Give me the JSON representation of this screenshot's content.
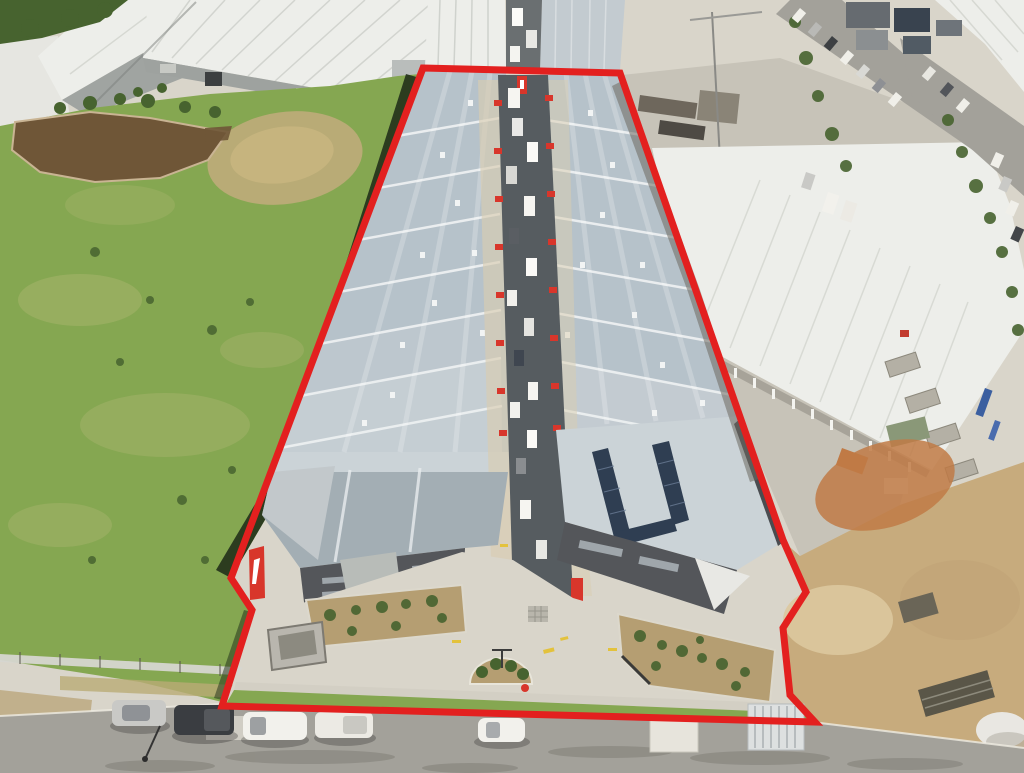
{
  "image": {
    "kind": "aerial-drone-photograph",
    "subject": "industrial warehouse estate outlined with red property boundary",
    "width": 1024,
    "height": 773
  },
  "boundary": {
    "points": "423,68 620,73 783,540 806,592 783,628 790,695 815,722 222,706 252,610 231,578",
    "color": "#e3201f",
    "stroke_width": 7
  },
  "palette": {
    "grass": "#85a751",
    "grass_light": "#a6b46c",
    "grass_dry": "#b9ab76",
    "pond": "#6f5637",
    "trees": "#47632f",
    "shadow": "#1c2916",
    "roof_blue": "#b6c2ca",
    "roof_blue_light": "#cbd3d7",
    "ridge_white": "#edf0f1",
    "lane": "#565c60",
    "concrete": "#d9d5ca",
    "concrete_mid": "#c7c3b8",
    "road": "#a3a19a",
    "road_dark": "#8a8881",
    "white_roof": "#edeeea",
    "roof_seam": "#d6d8d2",
    "grey_wall": "#a0a4a1",
    "dark_wall": "#54565a",
    "mulch": "#b59e72",
    "dirt": "#c7ab7d",
    "dirt_orange": "#c07a45",
    "sand": "#dbc89e",
    "solar": "#2f3e52",
    "accent_red": "#d8362b",
    "marking_yellow": "#e3c23c",
    "vehicle_white": "#f2f1ec",
    "vehicle_dark": "#3a3d41",
    "vehicle_silver": "#c9c9c6",
    "apron_beige": "#d9cdb0"
  }
}
